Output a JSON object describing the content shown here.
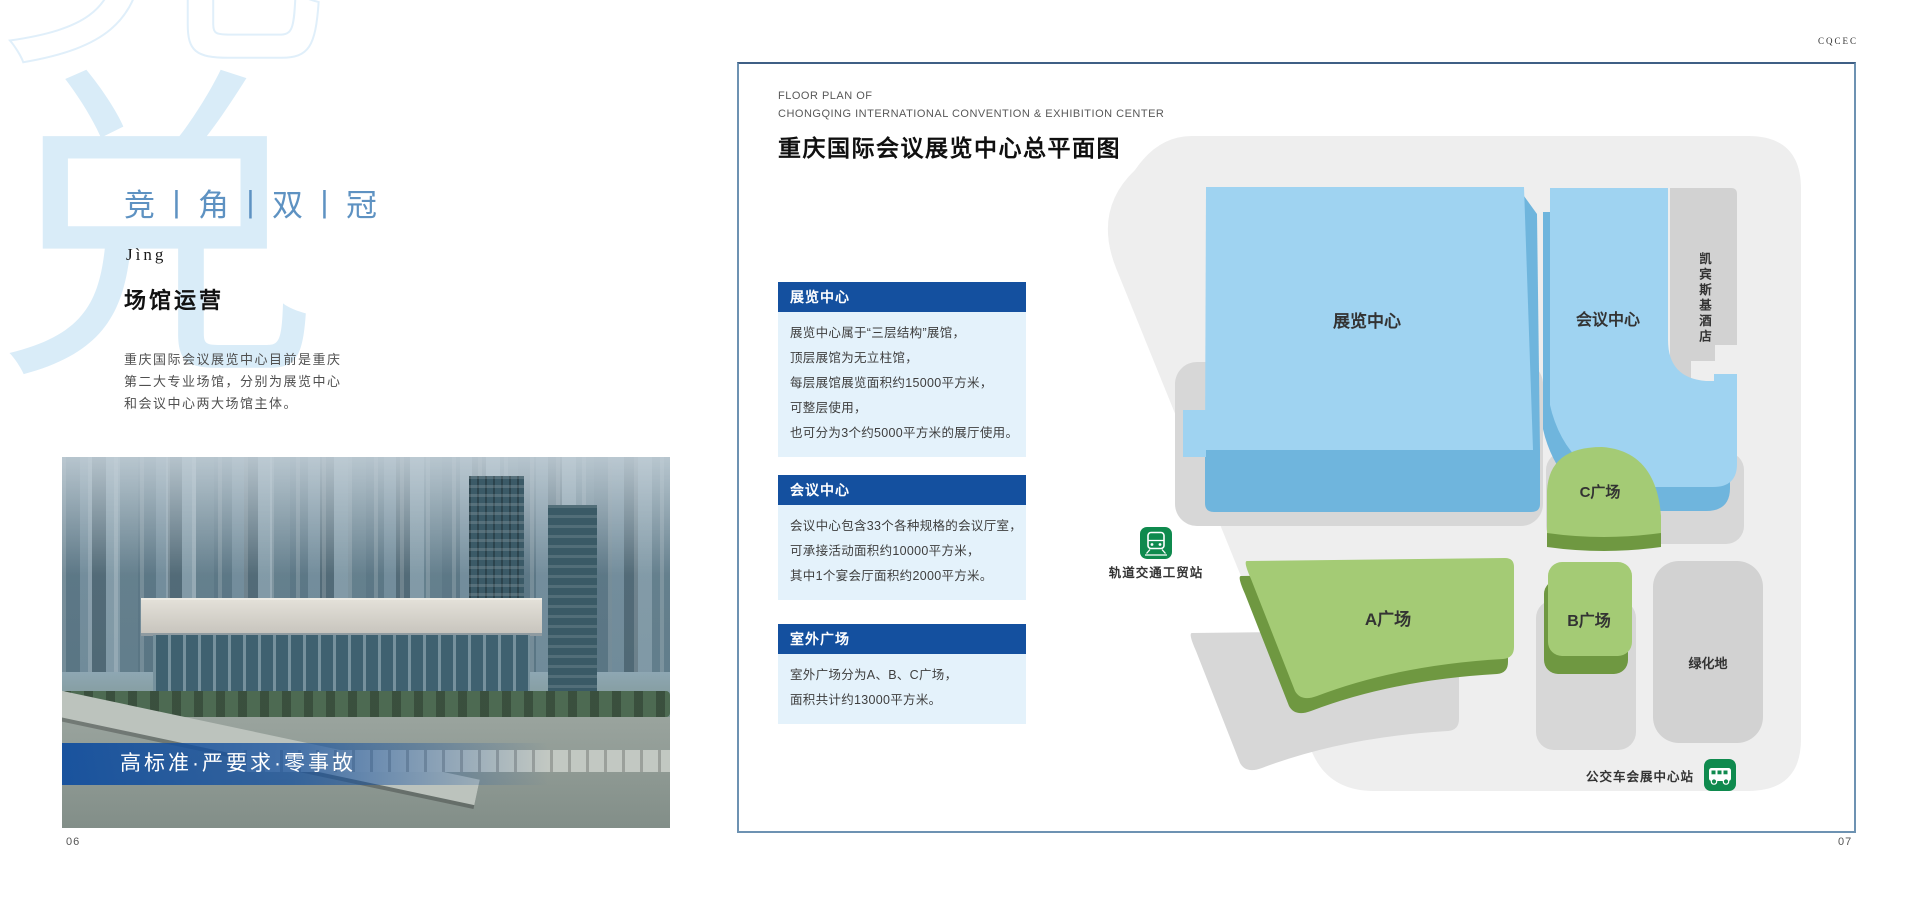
{
  "left_page": {
    "watermark_char": "兑",
    "watermark_outline_char": "竞",
    "series_title": "竞丨角丨双丨冠",
    "pinyin": "Jìng",
    "section_title": "场馆运营",
    "intro_lines": [
      "重庆国际会议展览中心目前是重庆",
      "第二大专业场馆，分别为展览中心",
      "和会议中心两大场馆主体。"
    ],
    "photo_caption": "高标准·严要求·零事故",
    "page_number": "06"
  },
  "right_page": {
    "corner_mark": "CQCEC",
    "header": {
      "eyebrow_line1": "FLOOR PLAN OF",
      "eyebrow_line2": "CHONGQING  INTERNATIONAL CONVENTION & EXHIBITION  CENTER",
      "title": "重庆国际会议展览中心总平面图"
    },
    "info_boxes": [
      {
        "title": "展览中心",
        "lines": [
          "展览中心属于“三层结构”展馆，",
          "顶层展馆为无立柱馆，",
          "每层展馆展览面积约15000平方米，",
          "可整层使用，",
          "也可分为3个约5000平方米的展厅使用。"
        ]
      },
      {
        "title": "会议中心",
        "lines": [
          "会议中心包含33个各种规格的会议厅室，",
          "可承接活动面积约10000平方米，",
          "其中1个宴会厅面积约2000平方米。"
        ]
      },
      {
        "title": "室外广场",
        "lines": [
          "室外广场分为A、B、C广场，",
          "面积共计约13000平方米。"
        ]
      }
    ],
    "map": {
      "labels": {
        "exhibition_center": "展览中心",
        "convention_center": "会议中心",
        "hotel": "凯宾斯基酒店",
        "plaza_a": "A广场",
        "plaza_b": "B广场",
        "plaza_c": "C广场",
        "green_area": "绿化地",
        "metro_station": "轨道交通工贸站",
        "bus_station": "公交车会展中心站"
      },
      "colors": {
        "site": "#eeeeee",
        "shadow": "#d7d7d7",
        "hotel_block": "#d2d2d2",
        "building_top": "#9fd3f1",
        "building_side": "#6fb5dd",
        "plaza_top": "#a4cb75",
        "plaza_side": "#6f9841",
        "station_icon_green": "#0f8a4e"
      }
    },
    "page_number": "07"
  },
  "accents": {
    "info_header_bg": "#14509f",
    "info_body_bg": "#e4f2fb",
    "frame_border": "#6d92b2",
    "series_title_color": "#5e92c2",
    "caption_band_blue": "#134f9e"
  }
}
